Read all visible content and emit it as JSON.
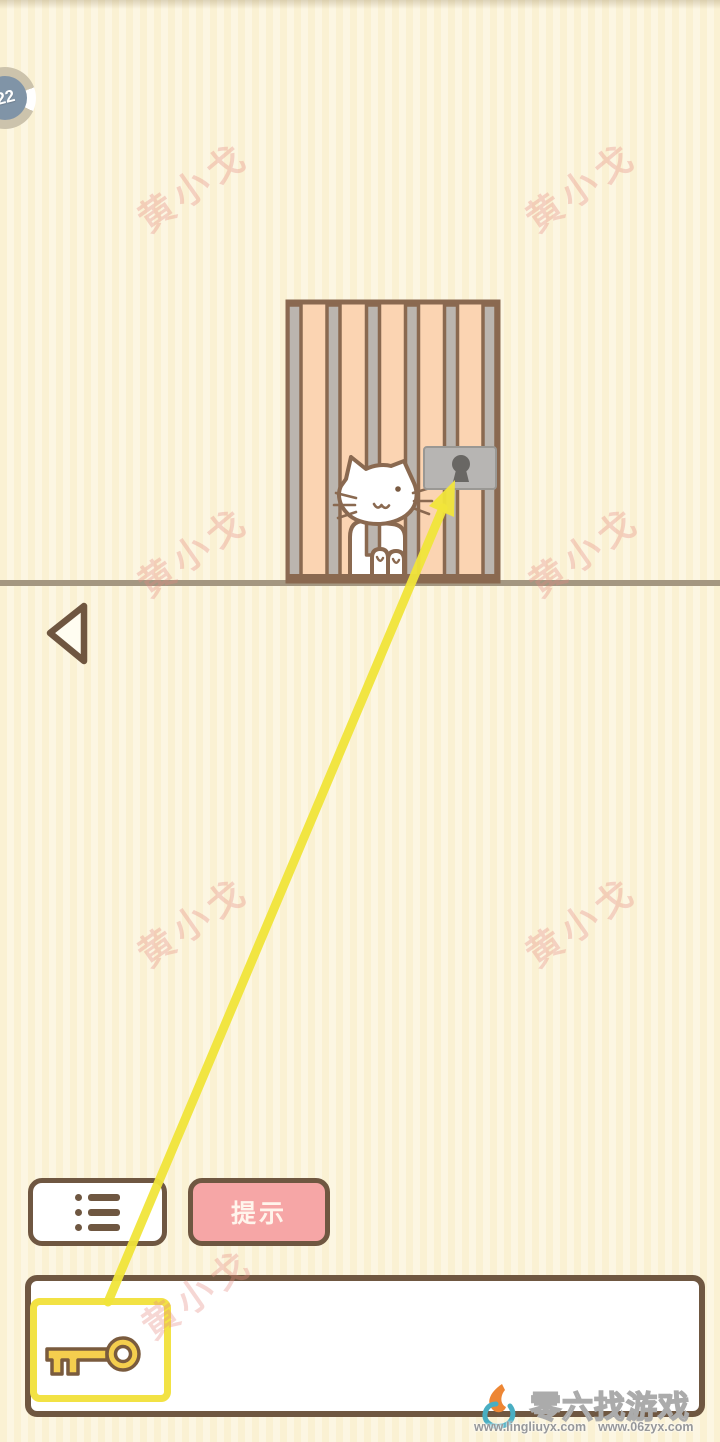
{
  "level_badge": {
    "value": "22"
  },
  "actions": {
    "hint_label": "提示"
  },
  "watermark": {
    "text": "黄小戈"
  },
  "footer_watermark": {
    "site_name": "零六找游戏",
    "url_left": "www.lingliuyx.com",
    "url_right": "www.06zyx.com"
  },
  "inventory": {
    "selected_item": "key"
  },
  "icons": {
    "menu": "list-icon",
    "back": "back-triangle-icon",
    "key": "key-icon",
    "lock": "padlock-icon",
    "cat": "cat-figure"
  },
  "colors": {
    "background_cream": "#FAF2D6",
    "outline_brown": "#6F5741",
    "cage_frame_brown": "#8A6950",
    "cage_peach": "#FBD4B2",
    "bar_gray": "#BBB5AF",
    "lock_gray": "#B7B5B3",
    "keyhole_gray": "#696764",
    "ground_tan": "#A49781",
    "hint_pink": "#F6A6A6",
    "select_yellow": "#F2E244",
    "arrow_yellow": "#F1E53A",
    "key_gold": "#F4CE4E",
    "badge_blue": "#8094A7",
    "watermark_pink": "#E48A82"
  }
}
